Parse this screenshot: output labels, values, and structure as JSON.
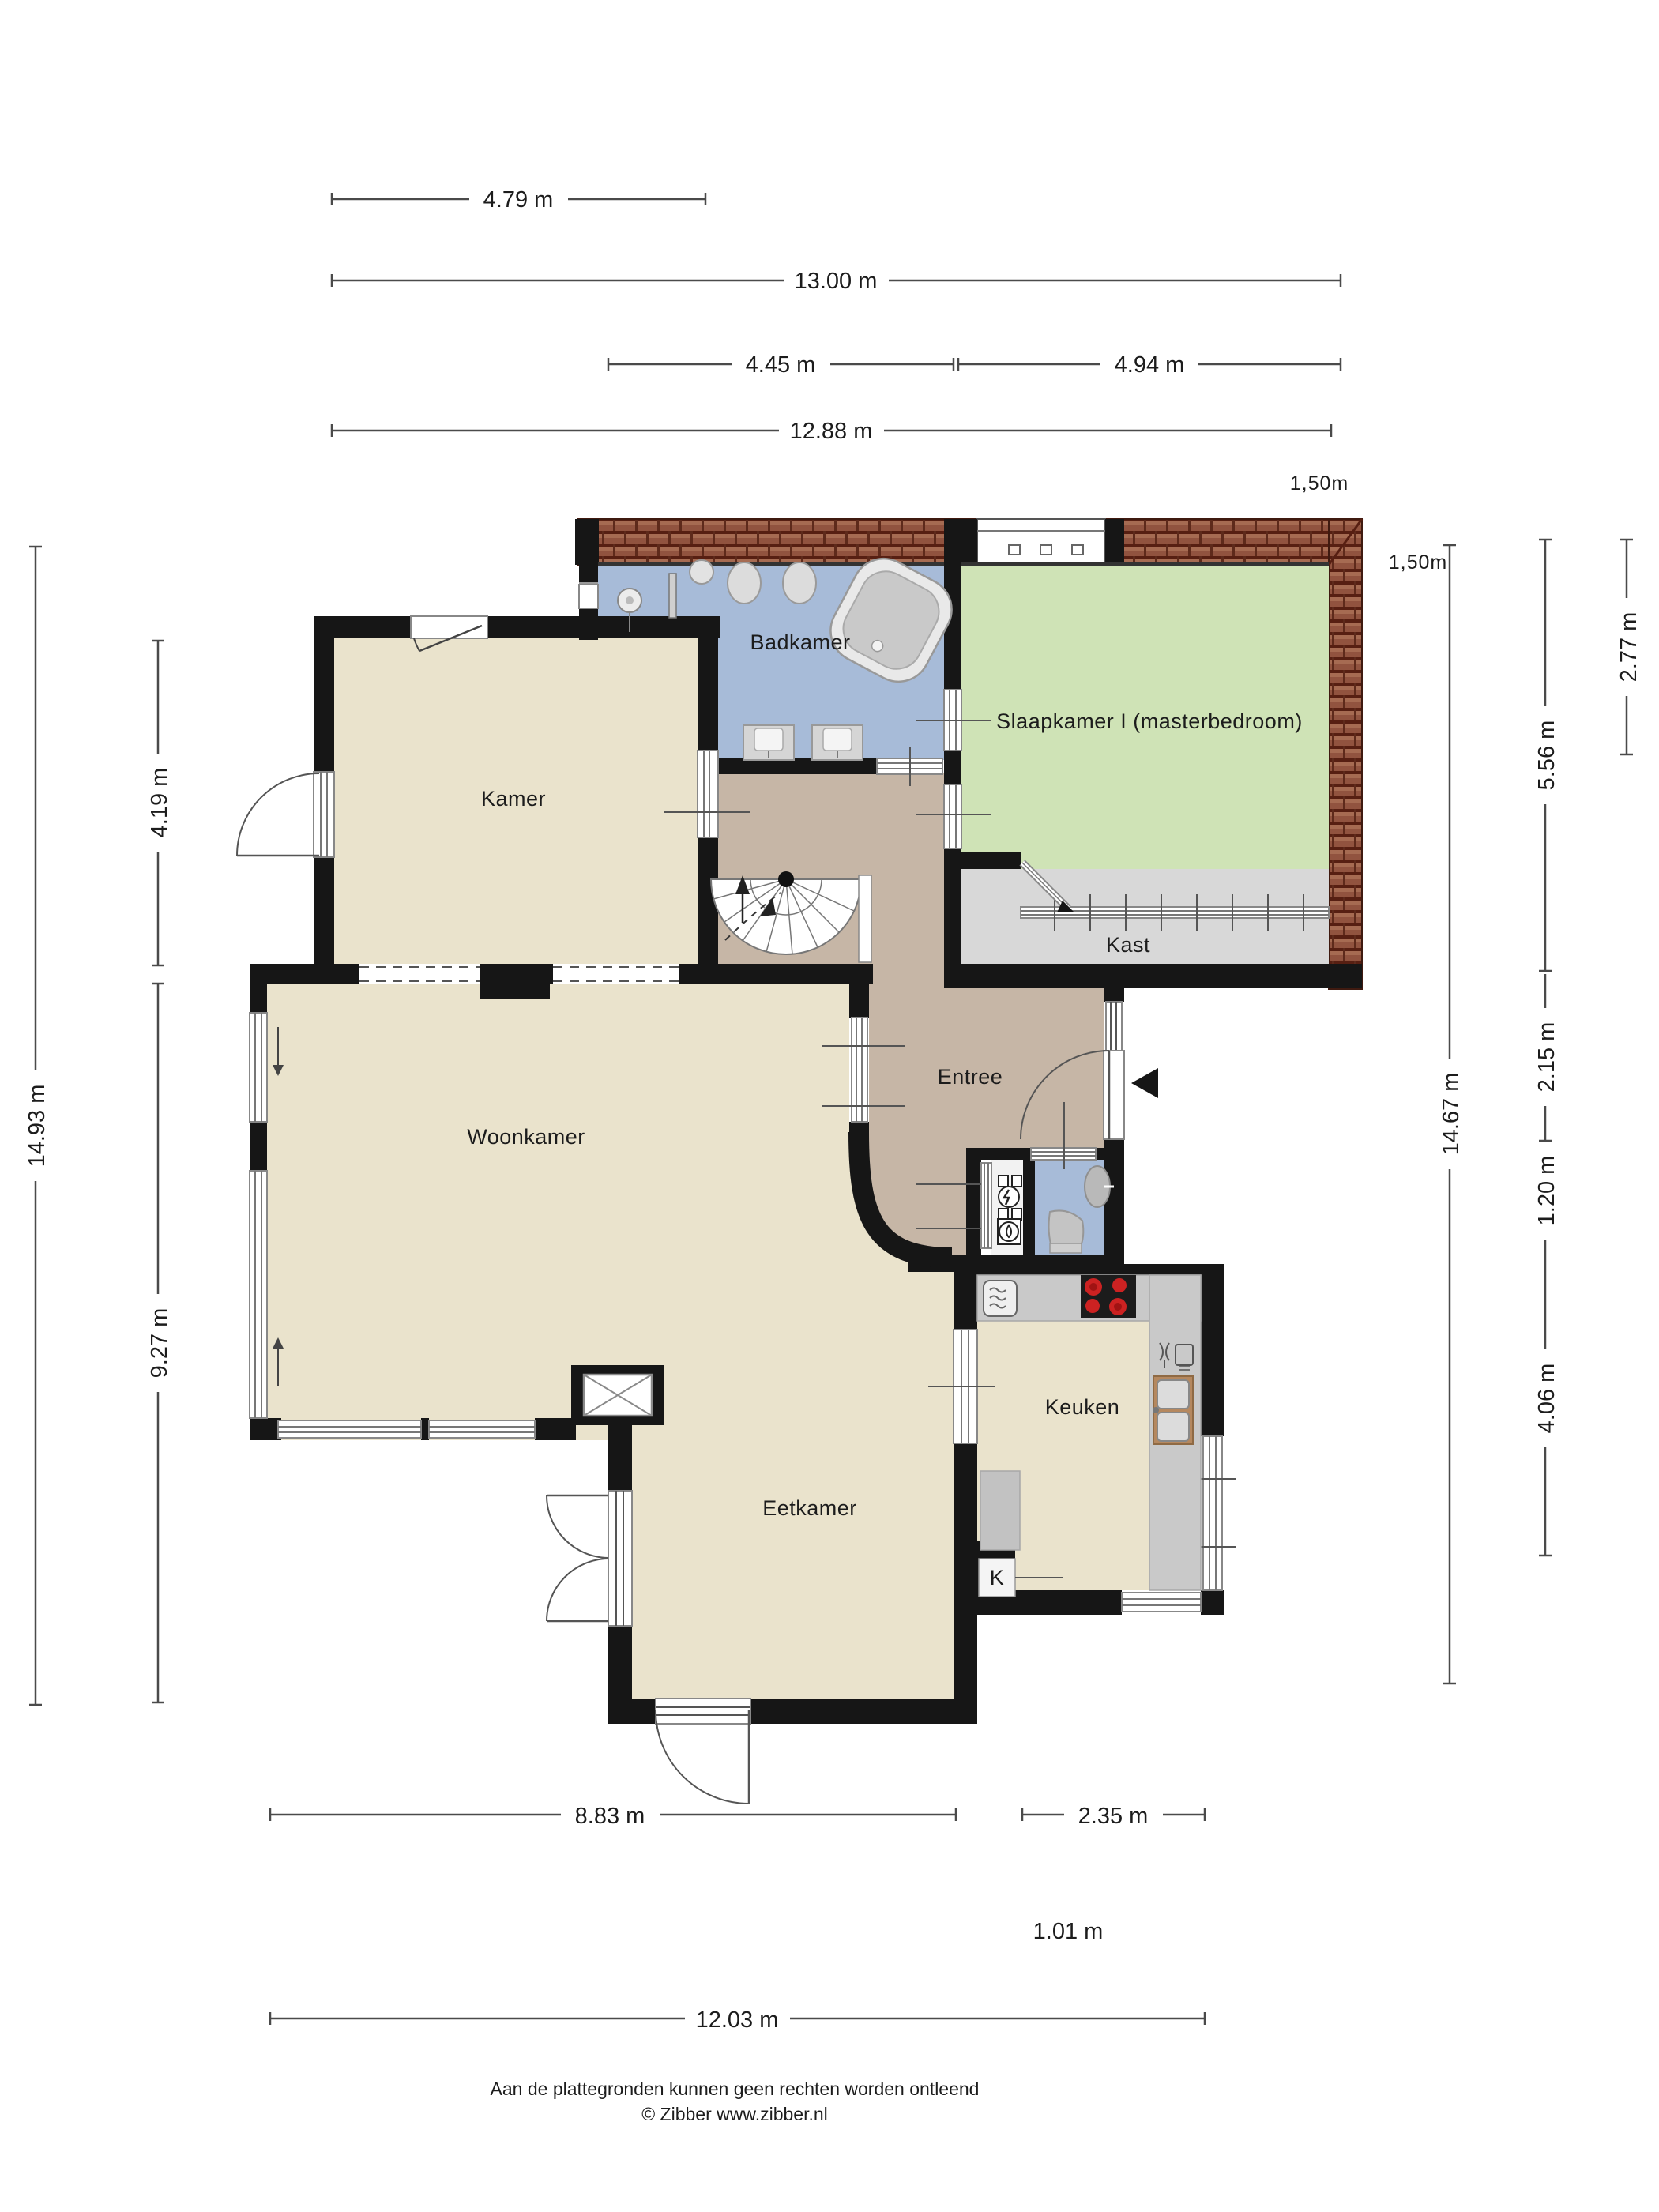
{
  "plan_title": "Begane grond plattegrond",
  "rooms": {
    "badkamer": "Badkamer",
    "slaapkamer": "Slaapkamer I (masterbedroom)",
    "kast": "Kast",
    "kamer": "Kamer",
    "entree": "Entree",
    "woonkamer": "Woonkamer",
    "keuken": "Keuken",
    "eetkamer": "Eetkamer",
    "k_closet": "K"
  },
  "dimensions": {
    "top_4_79": "4.79 m",
    "top_13_00": "13.00 m",
    "top_4_45": "4.45 m",
    "top_4_94": "4.94 m",
    "top_12_88": "12.88 m",
    "roof_150_top": "1,50m",
    "roof_150_right": "1,50m",
    "left_14_93": "14.93 m",
    "left_4_19": "4.19 m",
    "left_9_27": "9.27 m",
    "right_14_67": "14.67 m",
    "right_5_56": "5.56 m",
    "right_2_15": "2.15 m",
    "right_1_20": "1.20 m",
    "right_4_06": "4.06 m",
    "right_2_77": "2.77 m",
    "bottom_8_83": "8.83 m",
    "bottom_2_35": "2.35 m",
    "bottom_1_01": "1.01 m",
    "bottom_12_03": "12.03 m"
  },
  "footer": {
    "line1": "Aan de plattegronden kunnen geen rechten worden ontleend",
    "line2": "© Zibber www.zibber.nl"
  },
  "colors": {
    "wall": "#161616",
    "floor_beige": "#eae3cc",
    "floor_tan": "#c6b6a6",
    "floor_blue": "#a7bbd8",
    "floor_green": "#cfe3b6",
    "floor_gray": "#d8d8d8",
    "counter_gray": "#c9c9c9",
    "roof": "#8e5140",
    "burner_red": "#cc2222"
  }
}
